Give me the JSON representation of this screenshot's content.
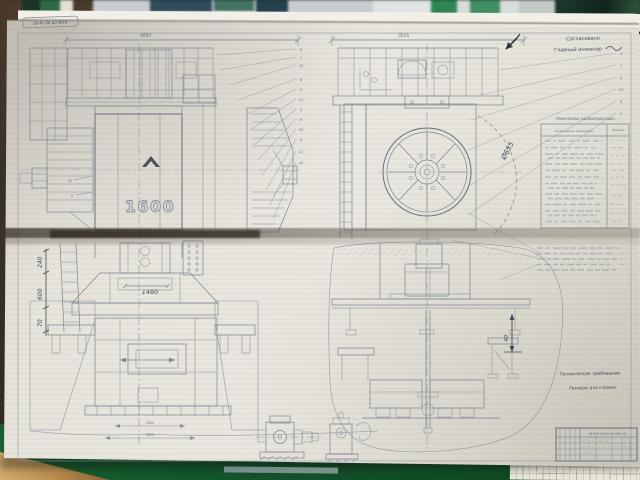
{
  "sheet": {
    "stamp": "18-4г-24 до №16",
    "model": "1600",
    "dims": {
      "front_width": "4850",
      "side_width": "3515",
      "ram": "1480",
      "flywheel": "Ø655",
      "gap": "40",
      "chain_a": "240",
      "chain_b": "600",
      "chain_c": "70",
      "base_a": "2000",
      "base_b": "3000"
    },
    "approval": {
      "line1": "Согласовано",
      "line2": "Главный инженер"
    },
    "spec": {
      "title": "Технические характеристики",
      "col_param": "Наименование параметров",
      "col_value": "Величина"
    },
    "notes": {
      "title": "Техническое требование",
      "line1": "Размеры для справок"
    },
    "titleblock": {
      "doc": "КГШП 08.02.00.000 СБ"
    },
    "callouts": {
      "left": [
        "6",
        "7",
        "15",
        "8",
        "2",
        "21",
        "4",
        "9",
        "10",
        "3",
        "12",
        "19"
      ],
      "right": [
        "4",
        "7",
        "3",
        "14",
        "9",
        "2"
      ],
      "far_left": [
        "51",
        "2"
      ]
    }
  }
}
